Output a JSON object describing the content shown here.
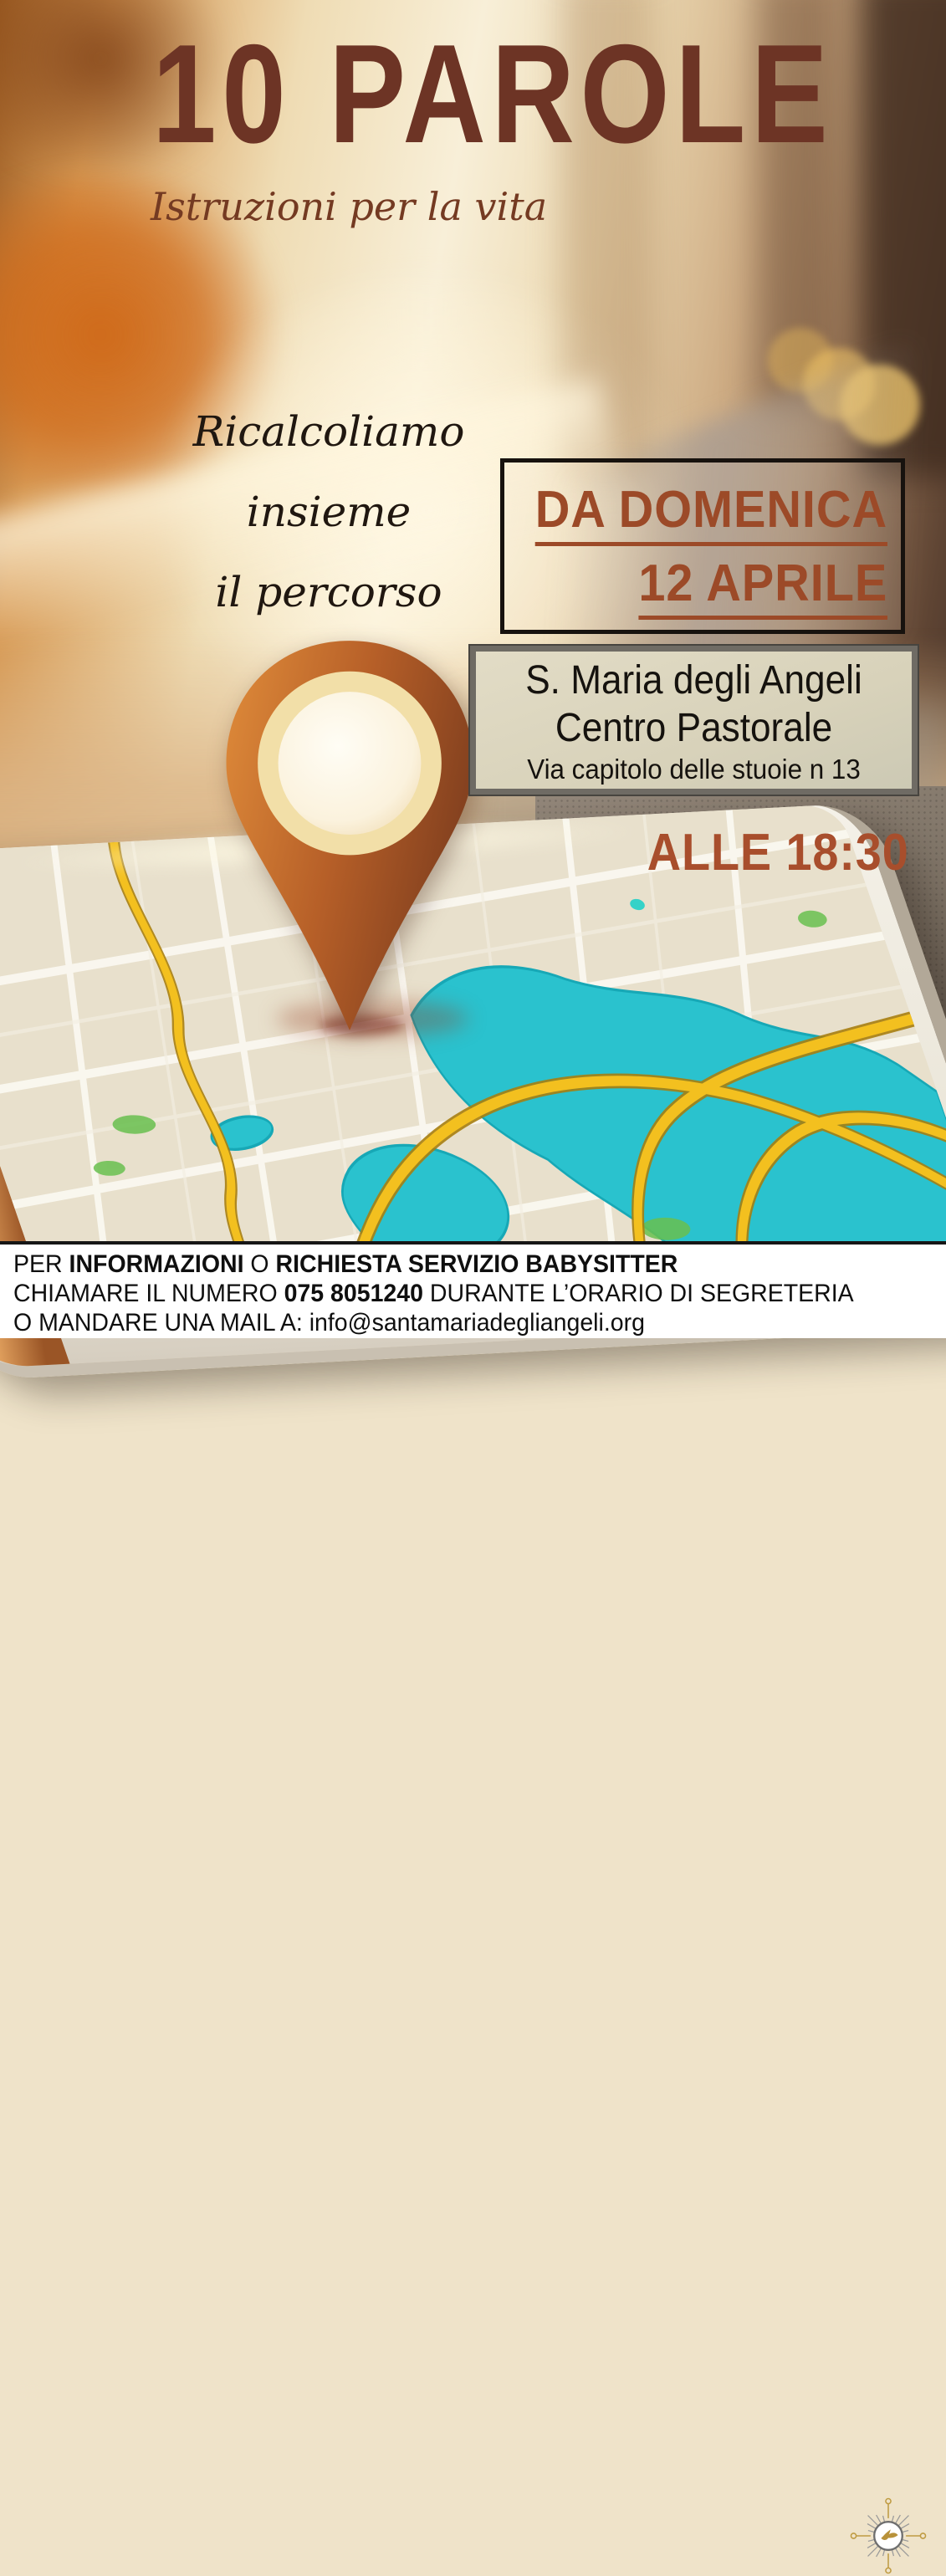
{
  "poster": {
    "title": "10 PAROLE",
    "subtitle": "Istruzioni per la vita",
    "tagline": [
      "Ricalcoliamo",
      "insieme",
      "il percorso"
    ],
    "date_box": {
      "line1": "DA DOMENICA",
      "line2": "12 APRILE"
    },
    "venue_box": {
      "line1": "S. Maria degli Angeli",
      "line2": "Centro Pastorale",
      "line3": "Via capitolo delle stuoie n 13"
    },
    "time": "ALLE 18:30",
    "footer": {
      "line1_parts": [
        "PER ",
        "INFORMAZIONI",
        " O ",
        "RICHIESTA SERVIZIO BABYSITTER"
      ],
      "line2_parts": [
        "CHIAMARE IL NUMERO ",
        "075 8051240",
        " DURANTE L’ORARIO DI SEGRETERIA"
      ],
      "line3": "O MANDARE UNA MAIL A: info@santamariadegliangeli.org"
    },
    "colors": {
      "title_brown": "#6d3425",
      "date_rust": "#9c4a28",
      "time_rust": "#a84e2c",
      "text_black": "#15120e",
      "venue_box_bg": "#dcd5bf",
      "footer_bg": "#ffffff",
      "logo_gold": "#b8923a",
      "map_water_teal": "#2ac2ce",
      "map_road_yellow": "#f3c01f",
      "pin_orange": "#c06428"
    },
    "icons": [
      "location-pin-icon",
      "dove-sunburst-logo-icon",
      "home-button"
    ]
  }
}
